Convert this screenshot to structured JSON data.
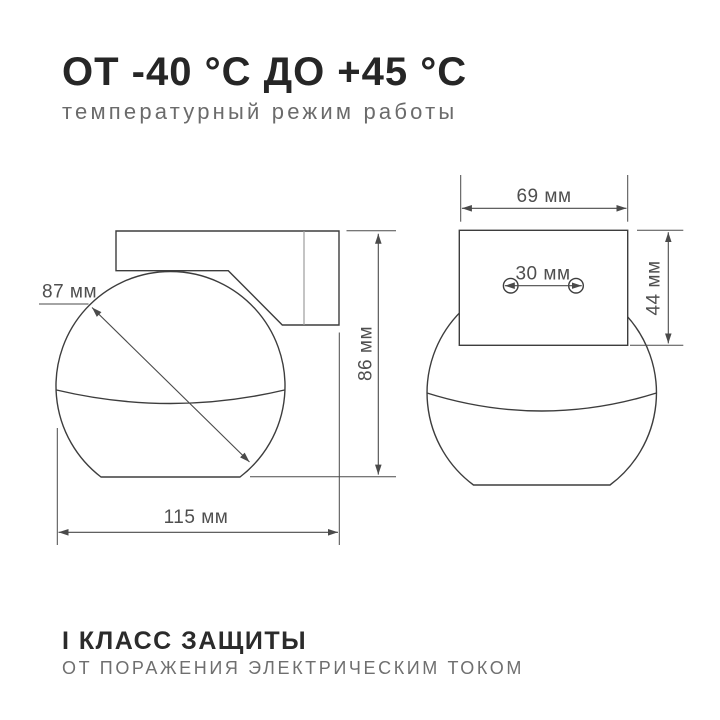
{
  "header": {
    "title": "ОТ -40 °C ДО +45 °C",
    "subtitle": "температурный режим работы"
  },
  "dimensions": {
    "sphere_diameter": "87 мм",
    "overall_width": "115 мм",
    "overall_height": "86 мм",
    "plate_width": "69 мм",
    "hole_spacing": "30 мм",
    "plate_height": "44 мм"
  },
  "footer": {
    "title": "I КЛАСС ЗАЩИТЫ",
    "subtitle": "ОТ ПОРАЖЕНИЯ ЭЛЕКТРИЧЕСКИМ ТОКОМ"
  },
  "colors": {
    "background": "#ffffff",
    "heading_text": "#262626",
    "muted_text": "#6b6b6b",
    "outline_line": "#3d3d3d",
    "dimension_line": "#4a4a4a",
    "joint_line": "#9c9c9c"
  }
}
